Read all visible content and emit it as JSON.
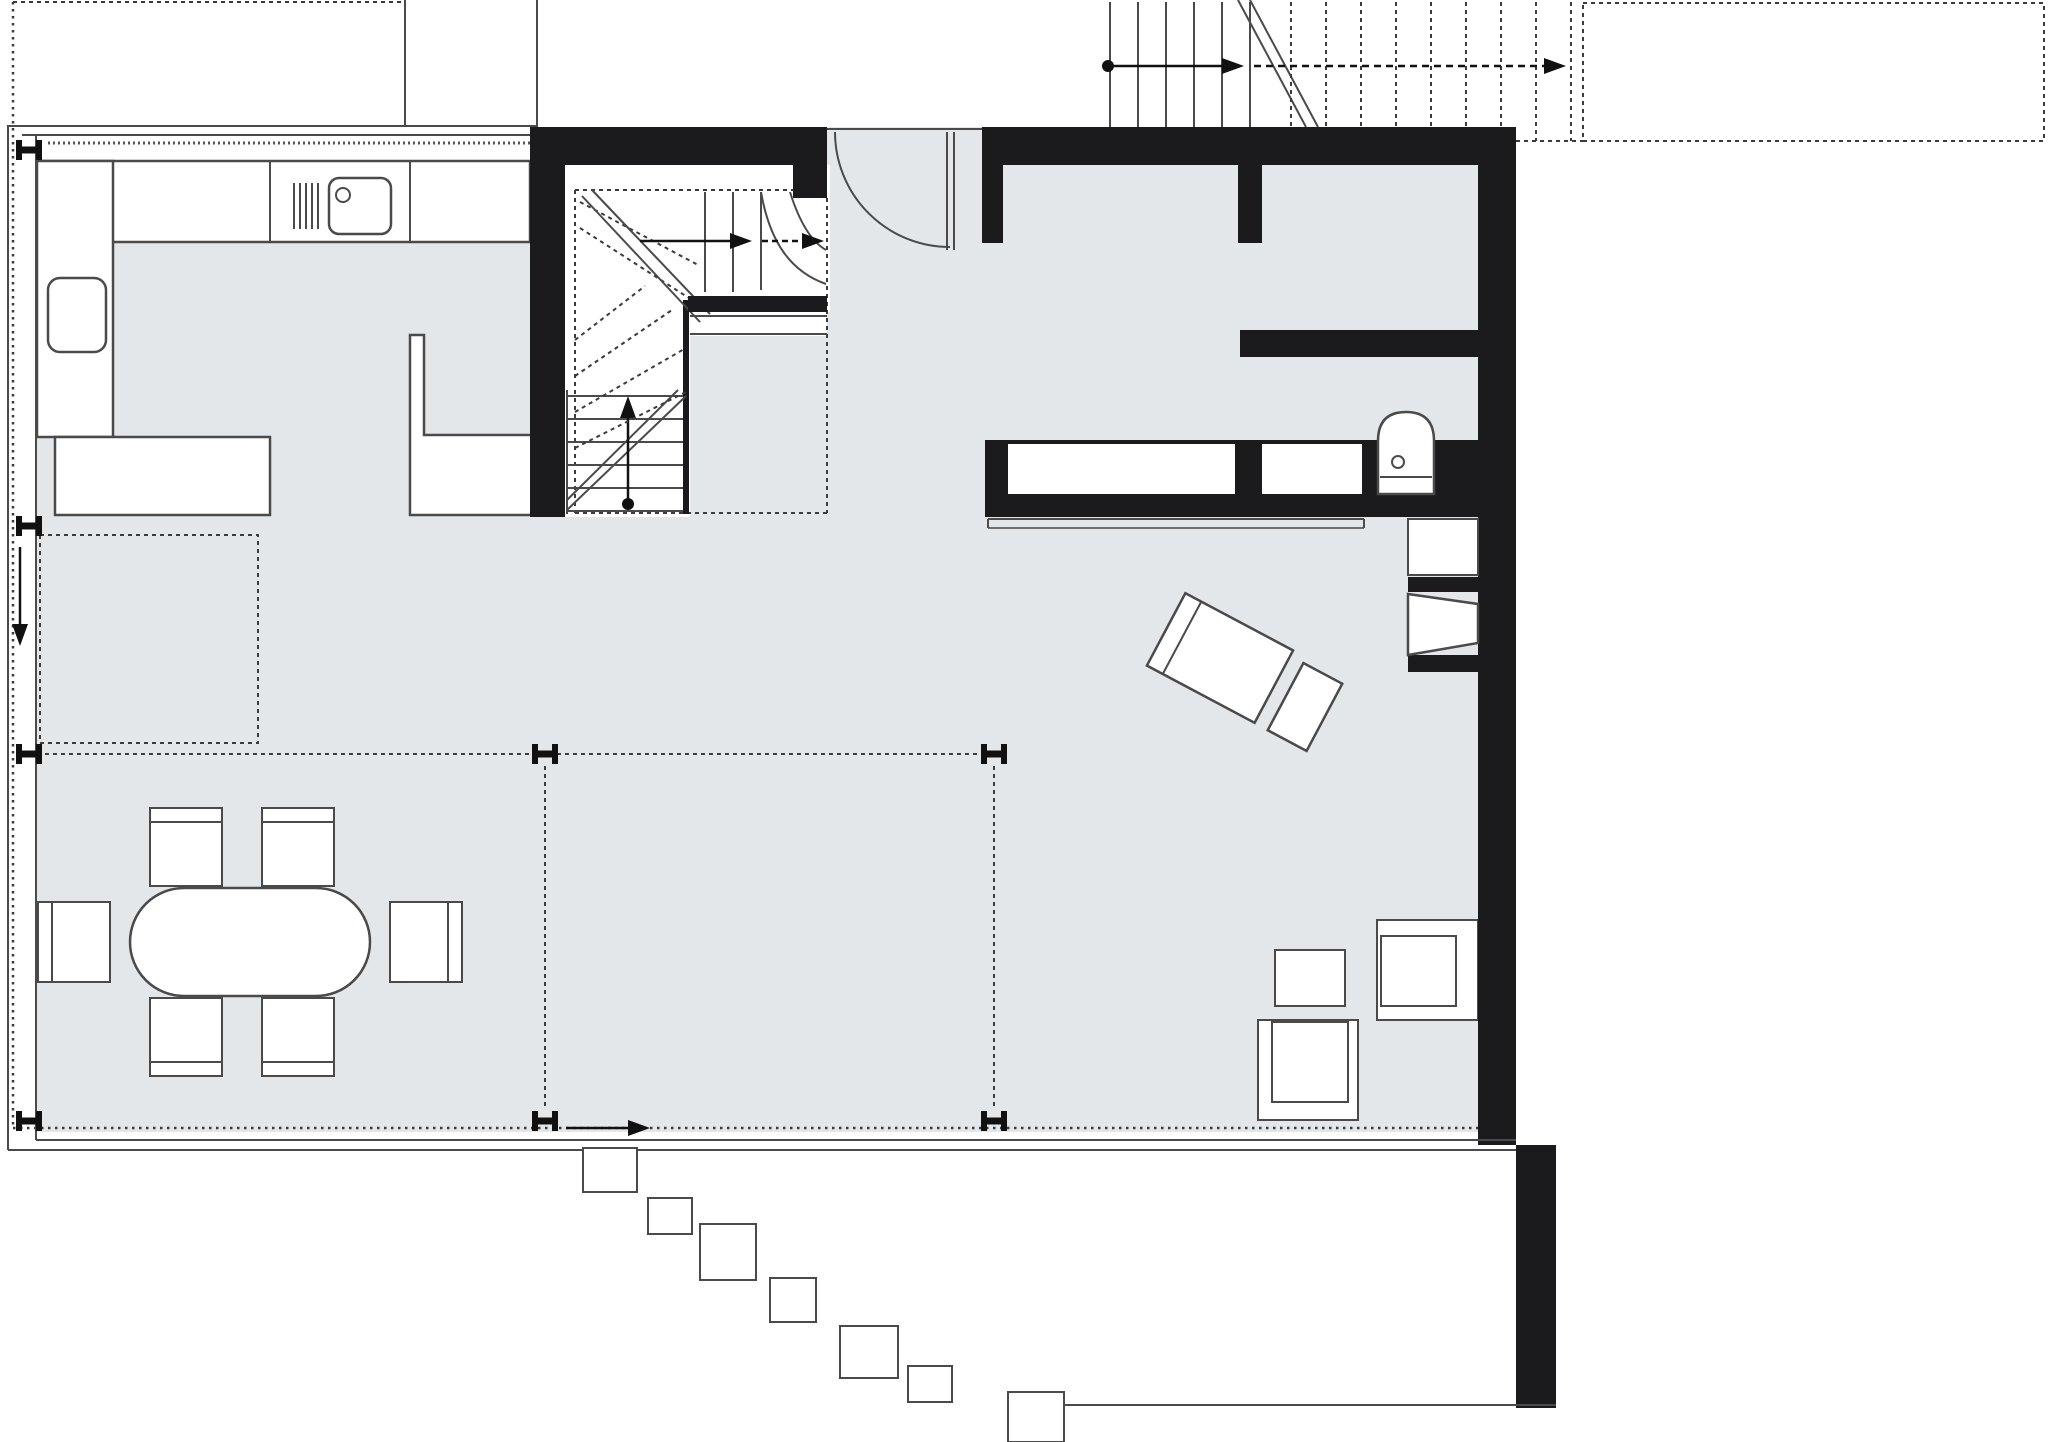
{
  "meta": {
    "kind": "architectural-floor-plan",
    "level": "ground-floor",
    "visible_text": []
  },
  "palette": {
    "bg": "#ffffff",
    "floor": "#e3e7ea",
    "wall": "#1b1b1d",
    "line": "#4a4a4a",
    "softline": "#6f6f6f",
    "dash": "#3c3c3c",
    "white": "#ffffff"
  },
  "inventory": {
    "column_markers": 8,
    "stepping_stones": 7,
    "dining_chairs": 6,
    "dining_tables": 1,
    "kitchen_items": [
      "north-counter",
      "west-counter",
      "island-counter",
      "bar-counter",
      "sink",
      "cooktop",
      "appliance"
    ],
    "stairs": [
      "interior-winder-stair",
      "exterior-stair-dashed-above"
    ],
    "bathroom_items": [
      "toilet",
      "wall-niche",
      "wall-niche"
    ],
    "living_items": [
      "chaise-longue",
      "ottoman",
      "armchair-right",
      "armchair-bottom",
      "side-table",
      "fireplace",
      "wall-shelf"
    ],
    "doors": [
      "entry-door-quarter-arc"
    ],
    "direction_arrows": [
      "exterior-stair-up",
      "interior-stair-up",
      "facade-down",
      "terrace-right"
    ]
  }
}
